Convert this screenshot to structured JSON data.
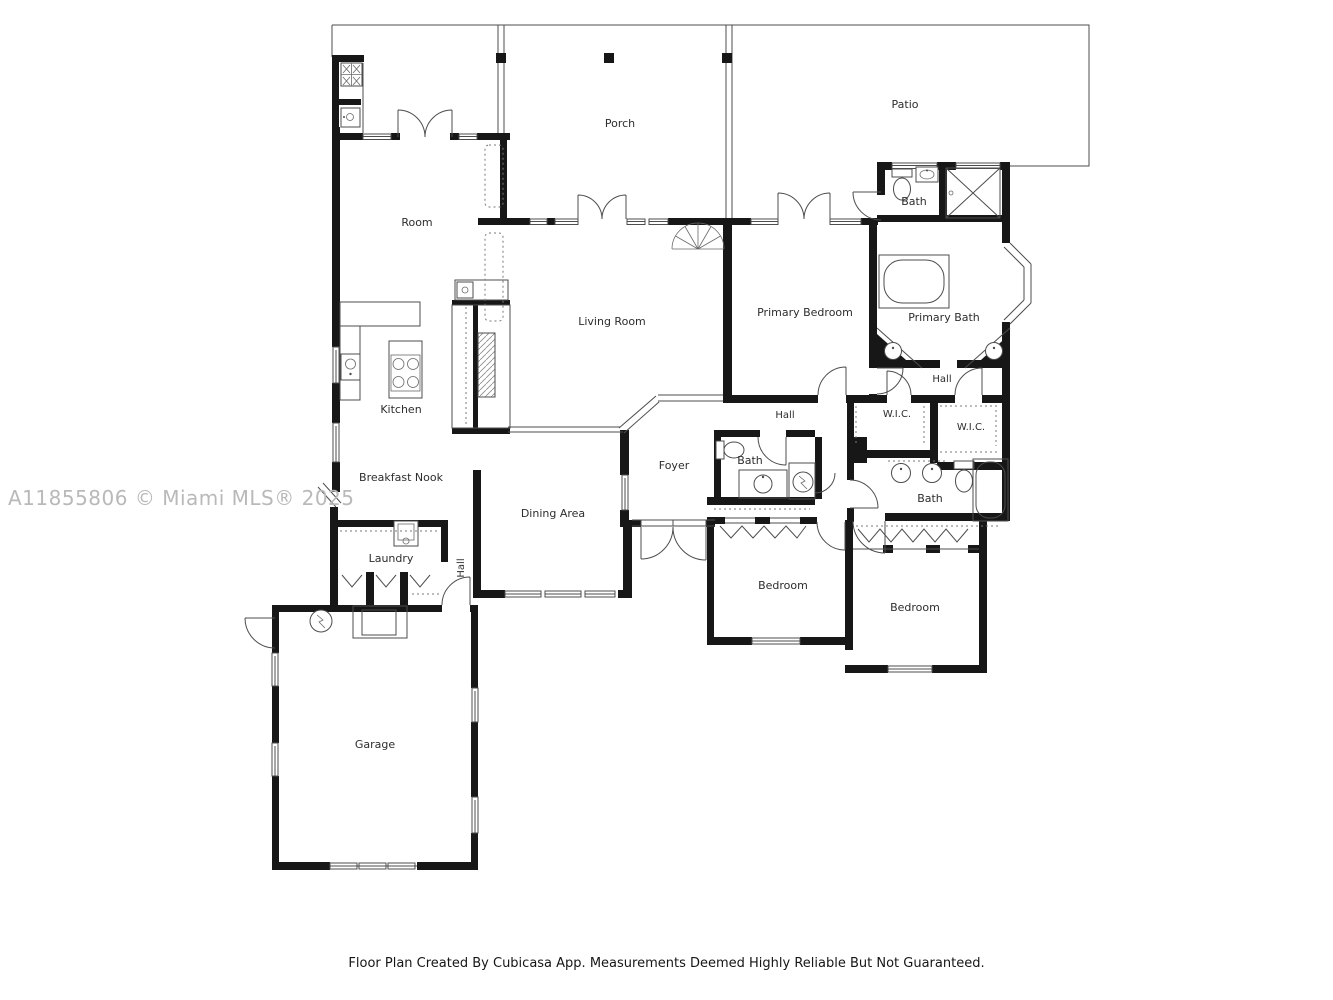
{
  "watermark": "A11855806 © Miami MLS® 2025",
  "footer": "Floor Plan Created By Cubicasa App. Measurements Deemed Highly Reliable But Not Guaranteed.",
  "rooms": {
    "porch": "Porch",
    "patio": "Patio",
    "room": "Room",
    "living_room": "Living Room",
    "kitchen": "Kitchen",
    "breakfast_nook": "Breakfast Nook",
    "dining_area": "Dining Area",
    "foyer": "Foyer",
    "laundry": "Laundry",
    "hall_entry": "Hall",
    "garage": "Garage",
    "primary_bedroom": "Primary Bedroom",
    "primary_bath": "Primary Bath",
    "bath_upper": "Bath",
    "hall_primary": "Hall",
    "hall_main": "Hall",
    "wic_left": "W.I.C.",
    "wic_right": "W.I.C.",
    "bath_middle": "Bath",
    "bath_lower": "Bath",
    "bedroom_front": "Bedroom",
    "bedroom_rear": "Bedroom"
  }
}
